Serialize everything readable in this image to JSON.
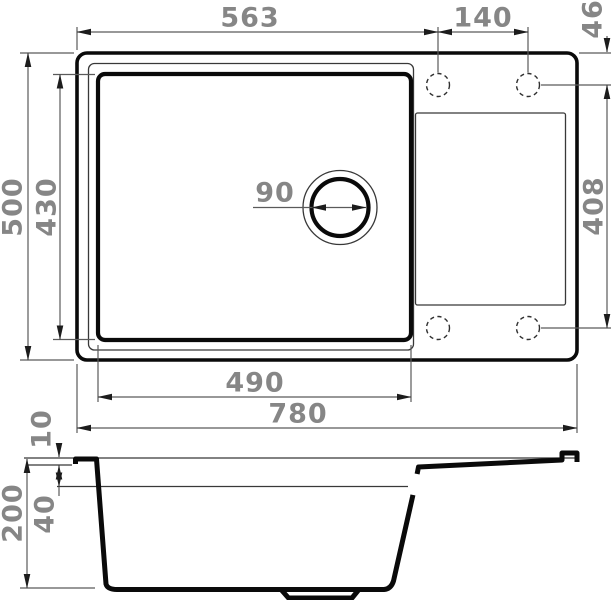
{
  "drawing": {
    "top_view": {
      "left_edge_to_faucet_hole": "563",
      "faucet_hole_spacing": "140",
      "top_edge_to_faucet_hole": "46",
      "overall_depth": "500",
      "bowl_inner_depth": "430",
      "drain_diameter": "90",
      "faucet_hole_rows_distance": "408",
      "bowl_inner_width": "490",
      "overall_width": "780"
    },
    "section_view": {
      "rim_height": "10",
      "ledge_depth": "40",
      "overall_height": "200"
    },
    "colors": {
      "outline": "#0a0a0a",
      "thin_line": "#383838",
      "dim_line": "#5a5a5a",
      "dim_text": "#868686",
      "background": "#ffffff"
    }
  }
}
